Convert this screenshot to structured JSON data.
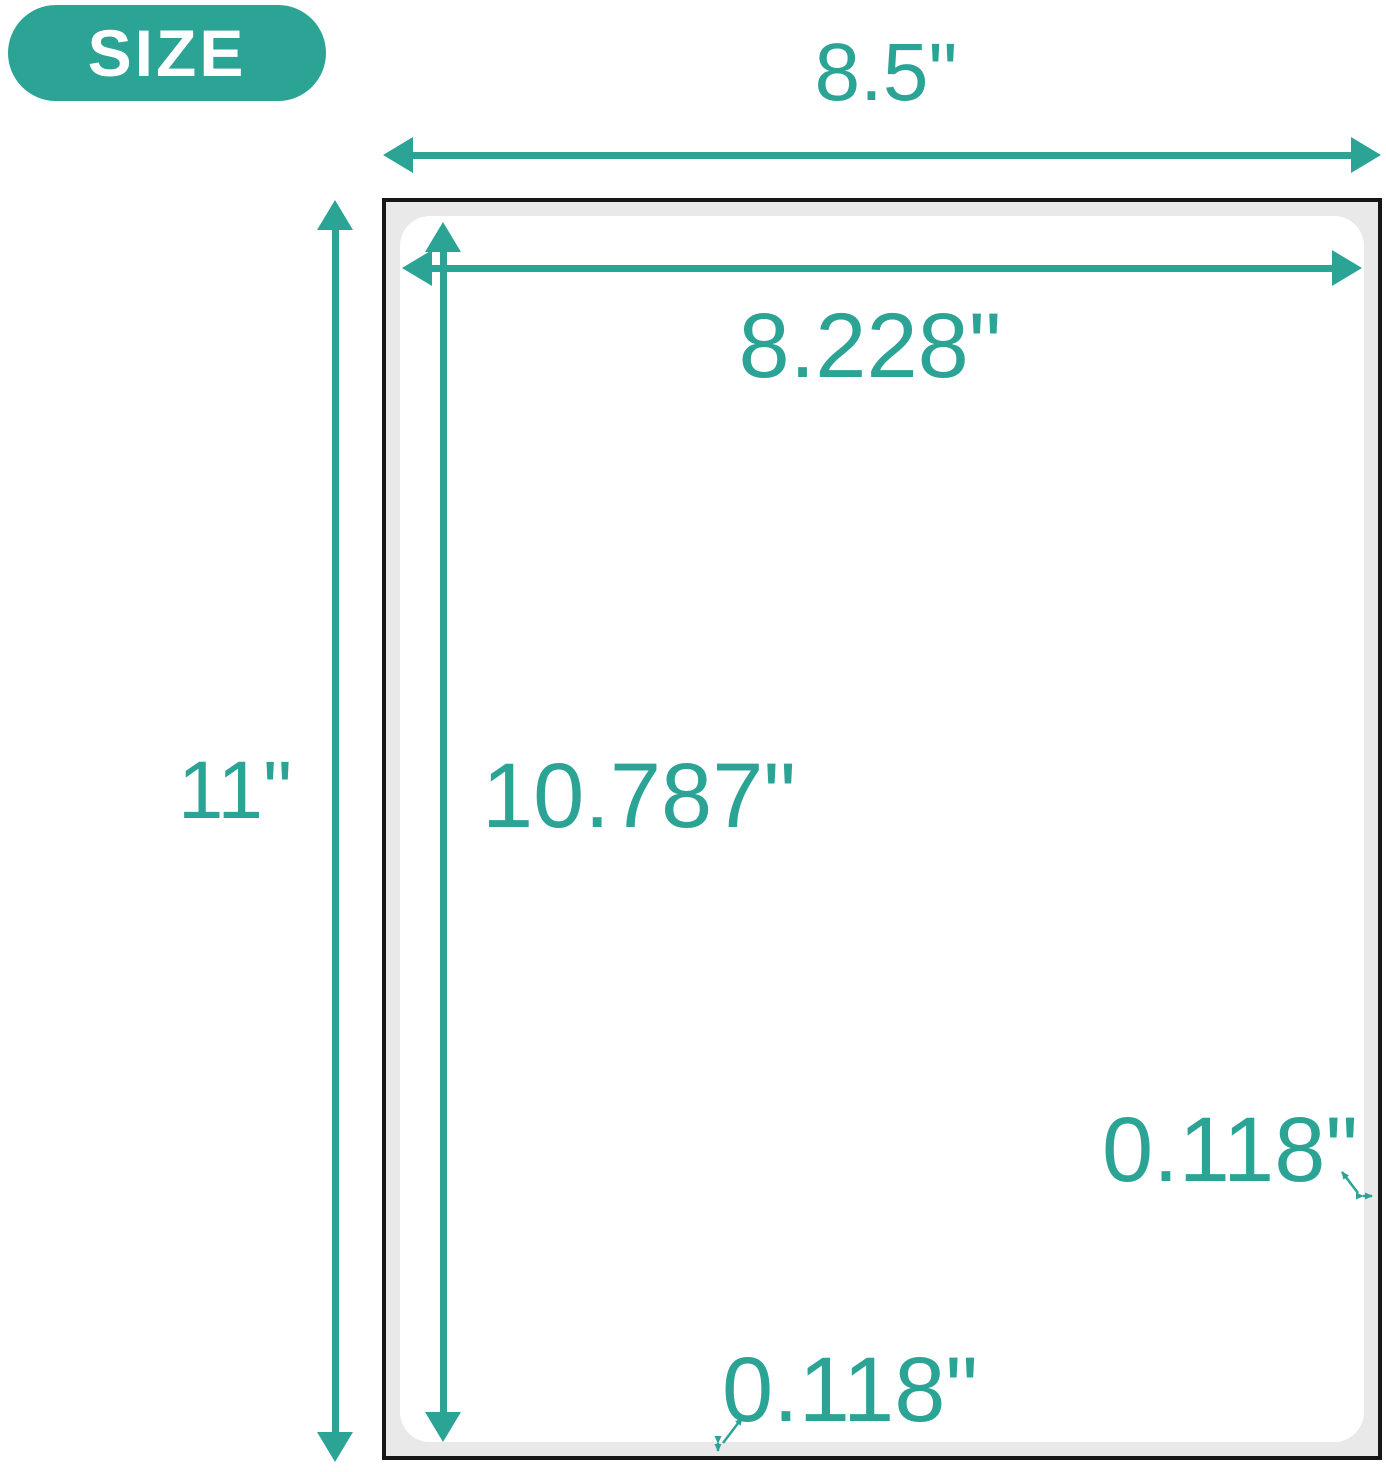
{
  "badge": {
    "label": "SIZE"
  },
  "dimensions": {
    "sheet_width": "8.5\"",
    "sheet_height": "11\"",
    "label_width": "8.228\"",
    "label_height": "10.787\"",
    "margin_right": "0.118\"",
    "margin_bottom": "0.118\""
  },
  "colors": {
    "accent": "#2BA496",
    "paper-border": "#161616",
    "paper-margin": "#e9e9e9",
    "page-background": "#ffffff",
    "badge-text": "#ffffff"
  }
}
